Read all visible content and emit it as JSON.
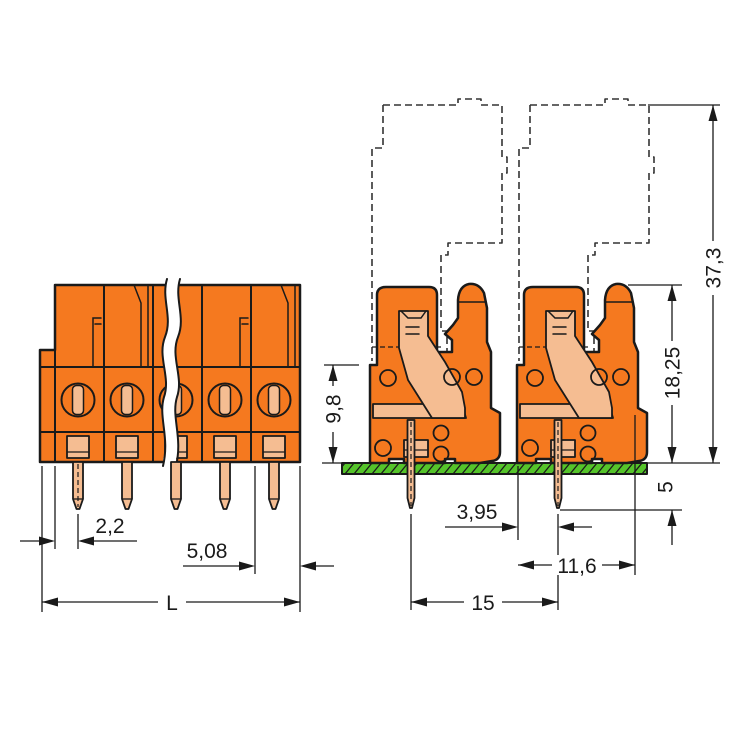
{
  "colors": {
    "housing_orange": "#F5791F",
    "contact_salmon": "#F5BD92",
    "pcb_green": "#55C42A",
    "line_black": "#1A1A1A",
    "plug_outline_gray": "#333333",
    "background": "#FFFFFF"
  },
  "drawing": {
    "front_view": {
      "dim_edge_to_pin": "2,2",
      "dim_pitch": "5,08",
      "dim_length": "L"
    },
    "side_view": {
      "dim_base_height": "9,8",
      "dim_housing_height": "18,25",
      "dim_total_height": "37,3",
      "dim_pin_below_board": "5",
      "dim_face_to_pin": "3,95",
      "dim_depth": "11,6",
      "dim_pin_spacing": "15"
    }
  }
}
